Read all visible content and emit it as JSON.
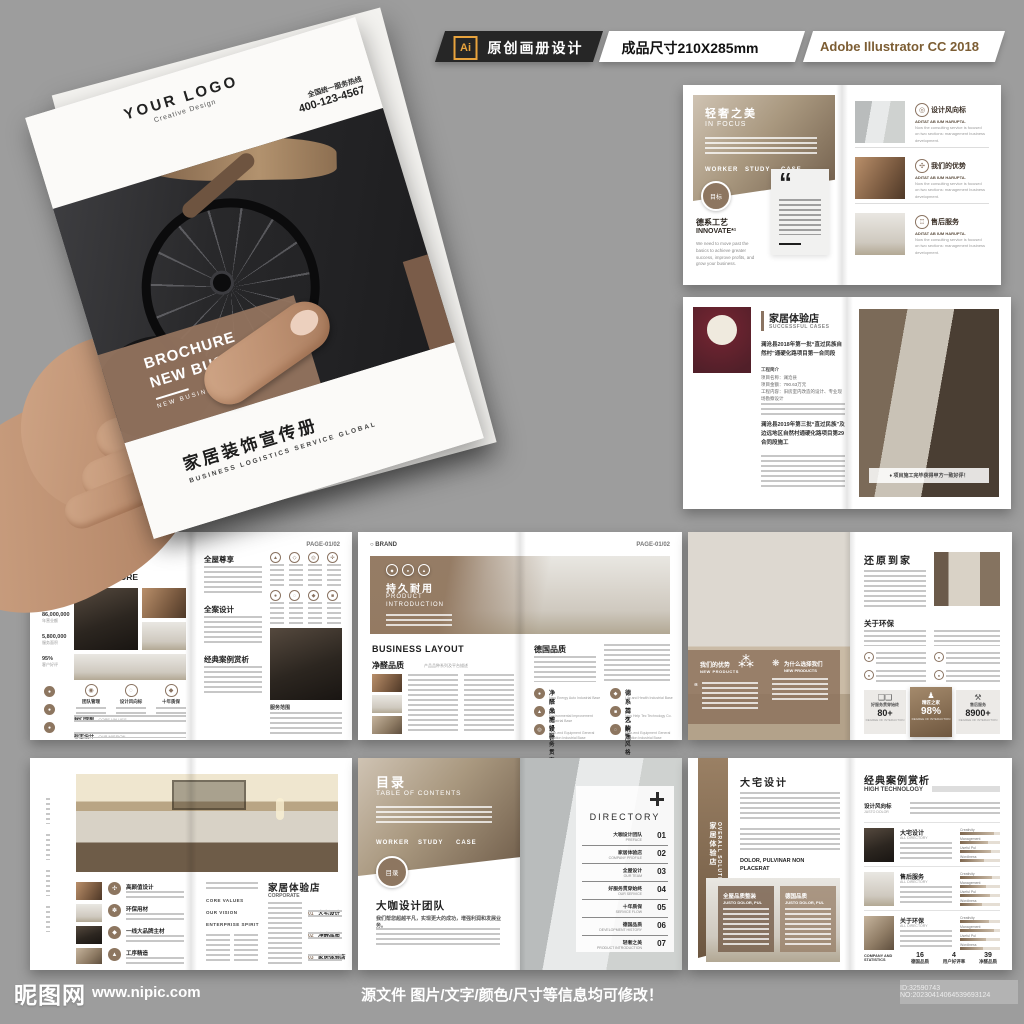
{
  "header": {
    "ai_logo": "Ai",
    "tab_design": "原创画册设计",
    "tab_size": "成品尺寸210X285mm",
    "tab_software": "Adobe Illustrator CC 2018"
  },
  "cover": {
    "logo": "YOUR LOGO",
    "logo_sub": "Creative Design",
    "hotline_label": "全国统一服务热线",
    "hotline_number": "400-123-4567",
    "title_line1": "BROCHURE",
    "title_line2": "NEW BUSINESS",
    "title_caption": "NEW BUSINESS BORCHURE",
    "cn_title": "家居装饰宣传册",
    "cn_caption": "BUSINESS LOGISTICS SERVICE GLOBAL"
  },
  "spread_focus": {
    "title": "轻奢之美",
    "subtitle": "IN FOCUS",
    "tabs": [
      "WORKER",
      "STUDY",
      "CASE"
    ],
    "badge": "目标",
    "quote_mark": "“",
    "craft_title": "德系工艺",
    "craft_sub": "INNOVATE*¹",
    "craft_body": "We need to move past the basics to achieve greater success, improve profits, and grow your business.",
    "item_caption": "ADITAT AB IUM HARUPTA.",
    "item_body": "Now the consulting service is focused on two sections: management business development.",
    "items": [
      {
        "title": "设计风向标"
      },
      {
        "title": "我们的优势"
      },
      {
        "title": "售后服务"
      }
    ]
  },
  "spread_cases": {
    "title": "家居体验店",
    "subtitle": "SUCCESSFUL CASES",
    "para1": "澜沧县2018年第一批“直过民族自然村”通硬化路项目第一合同段",
    "intro_label": "工程简介",
    "line_name": "项目名称：澜沧县",
    "line_amount": "项目金额：790.63万元",
    "line_scope": "工程内容：旧房室内改造的设计、专业现场勘察设计",
    "para2": "澜沧县2019年第三批“直过民族”及边远地区自然村通硬化路项目第29合同段施工",
    "badge": "项目施工完毕获得甲方一致好评！"
  },
  "spread_culture": {
    "brand": "BRAND",
    "page": "PAGE-01/02",
    "title": "装饰风格",
    "subtitle": "CORPORATE CULTURE",
    "stats": [
      {
        "value": "800,000",
        "label": "注册资金"
      },
      {
        "value": "86,000,000",
        "label": "年营业额"
      },
      {
        "value": "5,800,000",
        "label": "服务面积"
      },
      {
        "value": "95%",
        "label": "客户好评"
      }
    ],
    "features": [
      {
        "title": "团队管理"
      },
      {
        "title": "设计风向标"
      },
      {
        "title": "十年质保"
      }
    ],
    "block1_cn": "我们理想",
    "block1_en": "CORE VALUES",
    "block2_cn": "标志设计",
    "block2_en": "OUR MISSION",
    "sections": [
      {
        "title": "全屋尊享"
      },
      {
        "title": "全案设计"
      },
      {
        "title": "经典案例赏析"
      }
    ],
    "note": "服务范围"
  },
  "spread_product": {
    "brand": "BRAND",
    "page": "PAGE-01/02",
    "banner_title": "持久耐用",
    "banner_sub1": "PRODUCT",
    "banner_sub2": "INTRODUCTION",
    "heading": "BUSINESS LAYOUT",
    "sub_title": "净醛品质",
    "sub_caption": "产品品种系列及平台描述",
    "right_title": "德国品质",
    "grid": [
      {
        "title": "净醛品质",
        "caption": "New Energy Auto Industrial Base"
      },
      {
        "title": "德系工艺",
        "caption": "Life and Health Industrial Base"
      },
      {
        "title": "大宅设计",
        "caption": "Environmental Improvement Industrial Base"
      },
      {
        "title": "持久耐用",
        "caption": "New Help Tec Technology Co."
      },
      {
        "title": "好服务贯穿始终",
        "caption": "High-end Equipment General Aviation Industrial Base"
      },
      {
        "title": "装饰风格",
        "caption": "High-end Equipment General Aviation Industrial Base"
      }
    ]
  },
  "spread_home": {
    "overlay1_cn": "我们的优势",
    "overlay1_en": "NEW PRODUCTS",
    "overlay2_cn": "为什么选择我们",
    "overlay2_en": "NEW PRODUCTS",
    "quote_mark": "“",
    "title": "还原到家",
    "section": "关于环保",
    "stat_caption": "DEGREE OF INTERACTION",
    "stats": [
      {
        "label": "好服务贯穿始终",
        "value": "80+"
      },
      {
        "label": "精匠之家",
        "value": "98%"
      },
      {
        "label": "售后服务",
        "value": "8900+"
      }
    ]
  },
  "spread_store": {
    "items": [
      {
        "title": "高颜值设计"
      },
      {
        "title": "环保用材"
      },
      {
        "title": "一线大品牌主材"
      },
      {
        "title": "工序精造"
      }
    ],
    "mid_labels": [
      {
        "label": "CORE VALUES"
      },
      {
        "label": "OUR VISION"
      },
      {
        "label": "ENTERPRISE SPIRIT"
      }
    ],
    "title": "家居体验店",
    "subtitle": "CORPORATE",
    "nums": [
      {
        "num": "01",
        "title": "大宅设计"
      },
      {
        "num": "02",
        "title": "净醛品质"
      },
      {
        "num": "03",
        "title": "家居体验店"
      }
    ]
  },
  "spread_toc": {
    "title": "目录",
    "subtitle": "TABLE OF CONTENTS",
    "tabs": [
      "WORKER",
      "STUDY",
      "CASE"
    ],
    "badge": "目录",
    "team_title": "大咖设计团队",
    "team_sub": "我们帮您超越平凡，实现更大的成功，增强利润和发展业务。",
    "directory": "DIRECTORY",
    "items": [
      {
        "num": "01",
        "cn": "大咖设计团队",
        "en": "PREFACE"
      },
      {
        "num": "02",
        "cn": "家居体验店",
        "en": "COMPANY PROFILE"
      },
      {
        "num": "03",
        "cn": "全屋设计",
        "en": "OUR TEAM"
      },
      {
        "num": "04",
        "cn": "好服务贯穿始终",
        "en": "OUR SERVICE"
      },
      {
        "num": "05",
        "cn": "十年质保",
        "en": "SERVICE FLOW"
      },
      {
        "num": "06",
        "cn": "德国品质",
        "en": "DEVELOPMENT HISTORY"
      },
      {
        "num": "07",
        "cn": "轻奢之美",
        "en": "PRODUCT INTRODUCTION"
      }
    ]
  },
  "spread_solution": {
    "side_cn": "家居体验店",
    "side_en": "OVERALL SOLUTION",
    "title": "大宅设计",
    "subhead1": "DOLOR, PULVINAR NON",
    "subhead2": "PLACERAT",
    "card1_cn": "全屋品质整装",
    "card1_en": "JUSTO DOLOR, PUL",
    "card2_cn": "德国品质",
    "card2_en": "JUSTO DOLOR, PUL",
    "right_title": "经典案例赏析",
    "right_sub": "HIGH TECHNOLOGY",
    "label_cn": "设计风向标",
    "label_en": "JUSTO DOLOR",
    "rows": [
      {
        "title": "大宅设计",
        "caption": "ALL DIRECTORY"
      },
      {
        "title": "售后服务",
        "caption": "ALL DIRECTORY"
      },
      {
        "title": "关于环保",
        "caption": "ALL DIRECTORY"
      }
    ],
    "bar_labels": [
      {
        "label": "Creativity"
      },
      {
        "label": "Management"
      },
      {
        "label": "Useful Pul"
      },
      {
        "label": "Wordiness"
      }
    ],
    "stats_label": "COMPANY AND STATISTICS",
    "stats": [
      {
        "num": "16",
        "label": "德国品质"
      },
      {
        "num": "4",
        "label": "用户好评率"
      },
      {
        "num": "39",
        "label": "净醛品质"
      }
    ]
  },
  "footer": {
    "site": "昵图网",
    "url": "www.nipic.com",
    "notice": "源文件 图片/文字/颜色/尺寸等信息均可修改！",
    "id_text": "ID:32590743 NO:20230414064539693124"
  },
  "colors": {
    "accent": "#8a7361",
    "accent_dark": "#6e5844",
    "page_bg": "#9d9d9d",
    "ai_orange": "#e8a33d"
  }
}
